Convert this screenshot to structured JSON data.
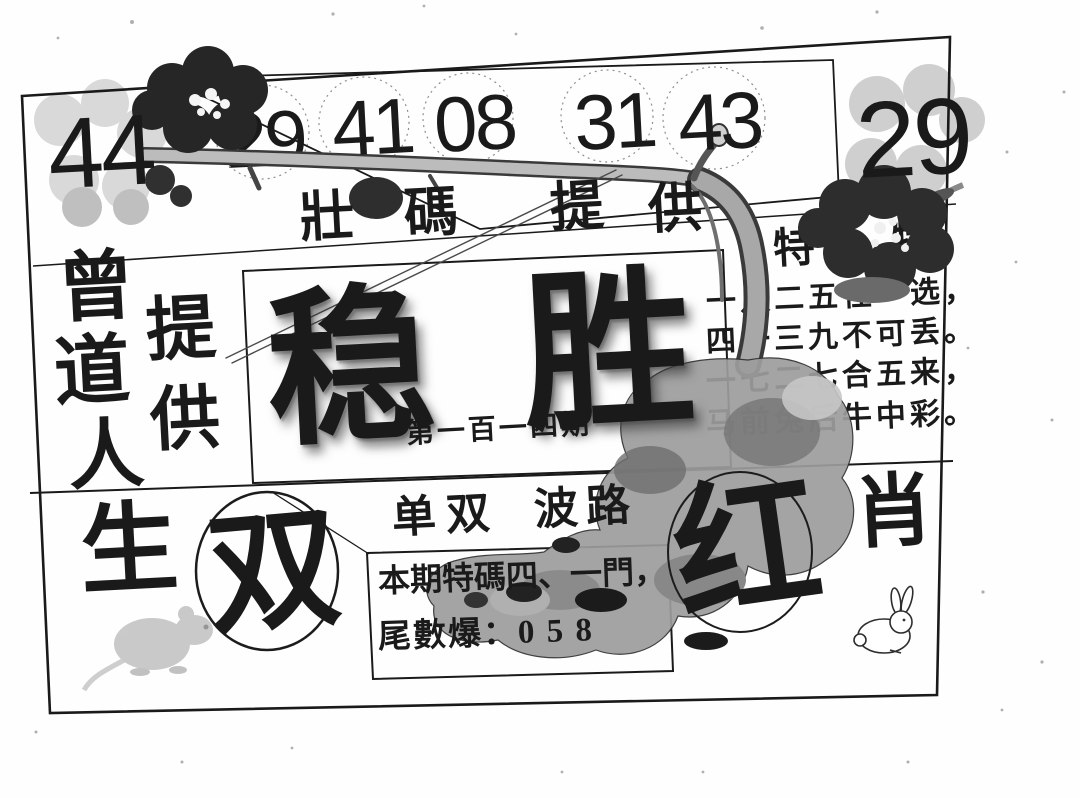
{
  "paper": {
    "bg": "#ffffff",
    "ink": "#1a1a1a",
    "art_grey": "#9d9d9d"
  },
  "top_row": {
    "left_number": "44",
    "circled_numbers": [
      "29",
      "41",
      "08",
      "31",
      "43"
    ],
    "right_number": "29"
  },
  "banner": {
    "chars": [
      "壯",
      "碼",
      "提",
      "供"
    ],
    "full": "壯碼提供"
  },
  "left_side": {
    "column1": [
      "曾",
      "道",
      "人"
    ],
    "column1_bottom": "生",
    "column2": [
      "提",
      "供"
    ]
  },
  "center": {
    "title_char1": "稳",
    "title_char2": "胜",
    "issue": "第一百一四期"
  },
  "poem": {
    "deco_char_left": "特",
    "deco_char_right": "特",
    "lines": [
      "一八二五任一选，",
      "四一三九不可丢。",
      "一七二七合五来，",
      "马前兔后牛中彩。"
    ]
  },
  "bottom_row": {
    "header_left": "单双",
    "header_right": "波路",
    "circled_double": "双",
    "circled_red": "红",
    "label_xiao": "肖",
    "tip_box": {
      "line1": "本期特碼四、一門，",
      "line2": "尾數爆：0 5 8"
    }
  },
  "icons": {
    "mouse": "mouse-silhouette",
    "rabbit": "rabbit-outline",
    "branch": "plum-blossom-branch",
    "rock": "ink-rock"
  }
}
